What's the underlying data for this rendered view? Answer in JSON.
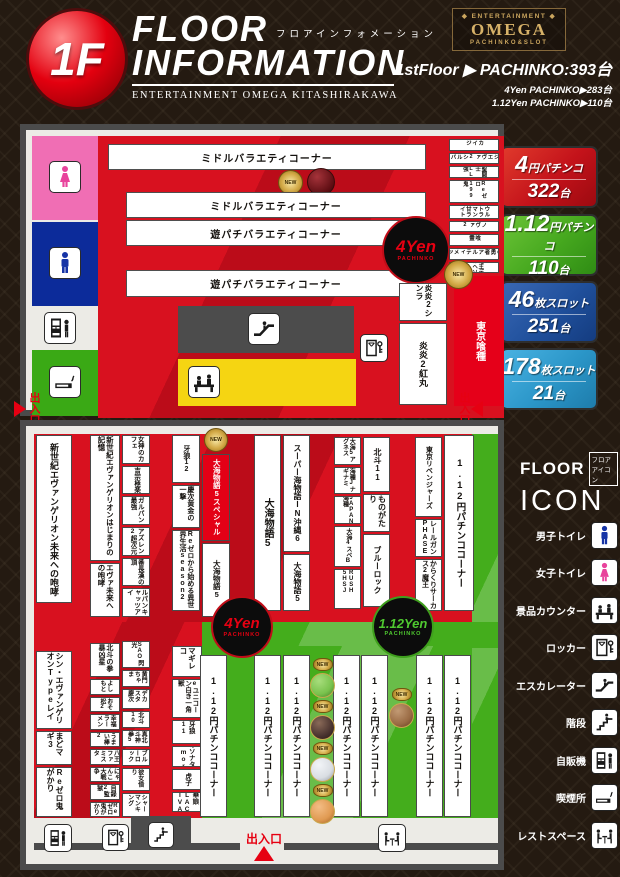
{
  "colors": {
    "red": "#d8111f",
    "green": "#44ad1c",
    "blue": "#20509c",
    "light_blue": "#2b96c8",
    "yellow": "#f5d512",
    "pink": "#f06eb4",
    "navy": "#0c2b9a",
    "accent_red": "#e60012"
  },
  "header": {
    "floor_badge": "1F",
    "title_en_1": "FLOOR",
    "title_jp": "フロアインフォメーション",
    "title_en_2": "INFORMATION",
    "subtitle": "ENTERTAINMENT OMEGA KITASHIRAKAWA",
    "logo_top": "◆ ENTERTAINMENT ◆",
    "logo_main": "OMEGA",
    "logo_bottom": "PACHINKO&SLOT",
    "stats_main": "1stFloor ▶ PACHINKO:393台",
    "stats_sub1": "4Yen PACHINKO▶283台",
    "stats_sub2": "1.12Yen PACHINKO▶110台"
  },
  "summary_panels": [
    {
      "big": "4",
      "small": "円パチンコ",
      "count": "322",
      "unit": "台"
    },
    {
      "big": "1.12",
      "small": "円パチンコ",
      "count": "110",
      "unit": "台"
    },
    {
      "big": "46",
      "small": "枚スロット",
      "count": "251",
      "unit": "台"
    },
    {
      "big": "178",
      "small": "枚スロット",
      "count": "21",
      "unit": "台"
    }
  ],
  "legend": {
    "floor": "FLOOR",
    "jp": "フロアアイコン",
    "icon_word": "ICON",
    "items": [
      {
        "label": "男子トイレ",
        "icon": "male"
      },
      {
        "label": "女子トイレ",
        "icon": "female"
      },
      {
        "label": "景品カウンター",
        "icon": "counter"
      },
      {
        "label": "ロッカー",
        "icon": "locker"
      },
      {
        "label": "エスカレーター",
        "icon": "escalator"
      },
      {
        "label": "階段",
        "icon": "stairs"
      },
      {
        "label": "自販機",
        "icon": "vending"
      },
      {
        "label": "喫煙所",
        "icon": "smoking"
      },
      {
        "label": "レストスペース",
        "icon": "rest"
      }
    ]
  },
  "map_top": {
    "rows": [
      "ミドルバラエティコーナー",
      "ミドルバラエティコーナー",
      "遊パチバラエティコーナー",
      "遊パチバラエティコーナー"
    ],
    "yen4_line1": "4Yen",
    "yen4_line2": "PACHINKO",
    "right_boxes": [
      "カイジ",
      "ゴジエヴァ2シルバー",
      "聖闘士LL強",
      "Reゼロ199鬼",
      "ウルトラマン甘ライト",
      "ノヴァ2",
      "喰霊",
      "真の勇者アルティメット",
      "竜王デカヘソ229"
    ],
    "enen_1": "炎炎2シンラ",
    "enen_2": "炎炎2紅丸",
    "ghoul": "東京喰種",
    "new_badge": "NEW"
  },
  "exits": {
    "left": "出入口",
    "right": "出入口",
    "bottom": "出入口"
  },
  "map_bottom": {
    "upper": {
      "c1": [
        "新世紀エヴァンゲリオン未来への咆哮"
      ],
      "c2": [
        "新世紀エヴァンゲリオンはじまりの記憶",
        "エヴァ未来への咆哮"
      ],
      "c3": [
        "女神のカフェ",
        "吉宗極楽",
        "ガルパン最強",
        "アズレン2超次元",
        "番長漢の頂",
        "ルパンキャッツアイ"
      ],
      "c4": [
        "牙狼12",
        "慶次黄金の一撃",
        "Reゼロから始める異世界生活season2"
      ],
      "c5_special": "大海物語5スペシャル",
      "c5_below": "大海物語5",
      "c6": [
        "大海物語5"
      ],
      "c7": [
        "スーパー海物語IN沖縄6",
        "大海物語5"
      ],
      "c8": [
        "大海5アグネス",
        "海種Jナギナミ",
        "JAPAN海種",
        "大海4スペB",
        "RUSH 5HSJ"
      ],
      "c9": [
        "北斗11",
        "ものがたり",
        "ブルーロック"
      ],
      "c10": [
        "東京リベンジャーズ",
        "レールガンPHASE",
        "からくりサーカス2魔王"
      ],
      "c11": [
        "1.12円パチンココーナー"
      ]
    },
    "yen112_line1": "1.12Yen",
    "yen112_line2": "PACHINKO",
    "lower": {
      "c1": [
        "シン・エヴァンゲリオンTypeレイ",
        "まどマギ3",
        "Reゼロ鬼がかり"
      ],
      "c2": [
        "北斗の拳暴凶星",
        "よしもと",
        "おそ松2",
        "幸福ラーメン",
        "うまい棒2",
        "八王ファミスタ",
        "にゃんこ大戦争",
        "目録2監獄",
        "Reゼロ鬼がかり"
      ],
      "c3": [
        "SAO閃光",
        "黄門ちゃま",
        "デカスタ慶次",
        "北斗10",
        "真北斗神拳5",
        "ブルーロック",
        "彼女借り",
        "シャーマンキング"
      ],
      "c4": [
        "マギレコ",
        "eユニコーン白き一角獣",
        "牙狼11",
        "冬のソナタMemory",
        "虎子",
        "中華娘BLACK DIVA"
      ],
      "green_label": "1.12円パチンココーナー"
    }
  }
}
